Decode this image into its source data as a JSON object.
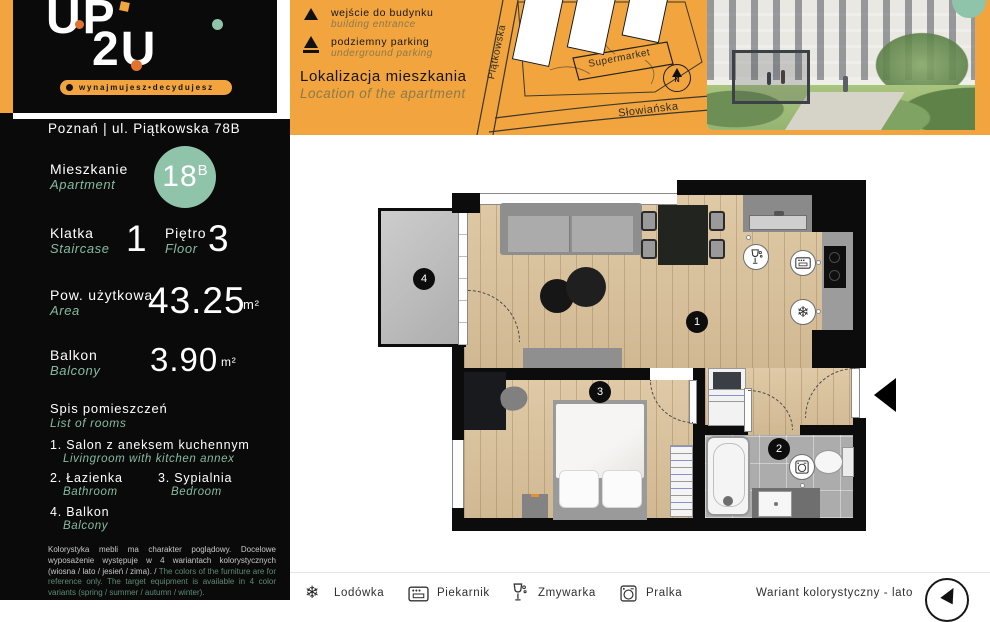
{
  "brand": {
    "logo_line1": "UP",
    "logo_line2": "2U",
    "tagline": "wynajmujesz•decydujesz",
    "address": "Poznań | ul. Piątkowska 78B"
  },
  "sidebar": {
    "apartment": {
      "label_pl": "Mieszkanie",
      "label_en": "Apartment",
      "number": "18",
      "suffix": "B"
    },
    "staircase": {
      "label_pl": "Klatka",
      "label_en": "Staircase",
      "value": "1"
    },
    "floor": {
      "label_pl": "Piętro",
      "label_en": "Floor",
      "value": "3"
    },
    "area": {
      "label_pl": "Pow. użytkowa",
      "label_en": "Area",
      "value": "43.25",
      "unit": "m²"
    },
    "balcony": {
      "label_pl": "Balkon",
      "label_en": "Balcony",
      "value": "3.90",
      "unit": "m²"
    },
    "rooms": {
      "header_pl": "Spis pomieszczeń",
      "header_en": "List of rooms",
      "items": [
        {
          "pl": "1. Salon z aneksem kuchennym",
          "en": "Livingroom with kitchen annex"
        },
        {
          "pl": "2. Łazienka",
          "en": "Bathroom"
        },
        {
          "pl": "3. Sypialnia",
          "en": "Bedroom"
        },
        {
          "pl": "4. Balkon",
          "en": "Balcony"
        }
      ]
    },
    "disclaimer_pl": "Kolorystyka mebli ma charakter poglądowy. Docelowe wyposażenie występuje w 4 wariantach kolorystycznych (wiosna / lato / jesień / zima). / ",
    "disclaimer_en": "The colors of the furniture are for reference only. The target equipment is available in 4 color variants (spring / summer / autumn / winter)."
  },
  "map": {
    "legend": [
      {
        "pl": "wejście do budynku",
        "en": "building entrance"
      },
      {
        "pl": "podziemny parking",
        "en": "underground parking"
      }
    ],
    "title_pl": "Lokalizacja mieszkania",
    "title_en": "Location of the apartment",
    "streets": [
      "Piątkowska",
      "Słowiańska"
    ],
    "poi": "Supermarket",
    "compass": "N"
  },
  "plan": {
    "badges": [
      "1",
      "2",
      "3",
      "4"
    ]
  },
  "footer": {
    "appliances": [
      {
        "name": "fridge",
        "label": "Lodówka",
        "glyph": "❄"
      },
      {
        "name": "oven",
        "label": "Piekarnik"
      },
      {
        "name": "dishwasher",
        "label": "Zmywarka"
      },
      {
        "name": "washer",
        "label": "Pralka"
      }
    ],
    "variant": "Wariant kolorystyczny - lato"
  },
  "colors": {
    "orange": "#f2a43e",
    "teal": "#8fc3aa",
    "black": "#0c0c0c",
    "wood": "#dbc29a"
  }
}
